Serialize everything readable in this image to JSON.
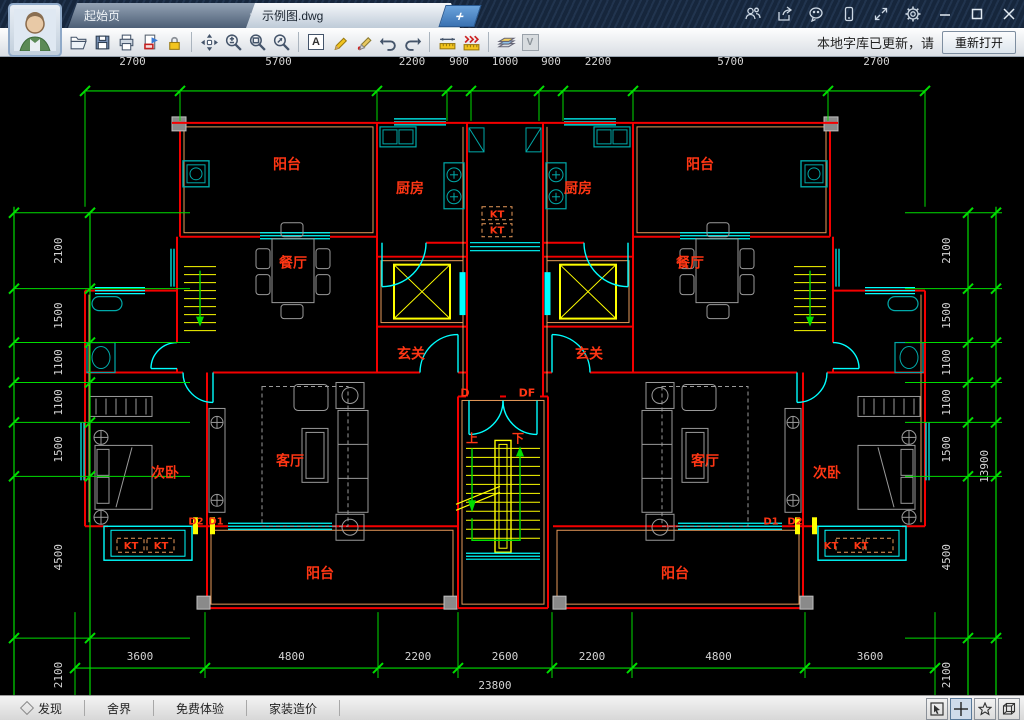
{
  "titlebar": {
    "tabs": [
      {
        "label": "起始页",
        "active": false
      },
      {
        "label": "示例图.dwg",
        "active": true
      }
    ],
    "plus_label": "+",
    "close_glyph": "×",
    "control_icons": [
      "contacts-icon",
      "share-icon",
      "wechat-icon",
      "mobile-icon",
      "fullscreen-icon",
      "settings-icon",
      "minimize-icon",
      "maximize-icon",
      "close-icon"
    ]
  },
  "toolbar": {
    "icons": [
      "open",
      "save",
      "print",
      "export-pdf",
      "lock",
      "pan",
      "zoom",
      "zoom-window",
      "zoom-extents",
      "text",
      "pencil",
      "marker",
      "undo",
      "redo",
      "measure",
      "measure-continuous",
      "layers",
      "view-v"
    ],
    "text_tool_letter": "A",
    "v_tool_letter": "V",
    "notice": "本地字库已更新，请",
    "reopen_button": "重新打开"
  },
  "statusbar": {
    "items": [
      "发现",
      "舍界",
      "免费体验",
      "家装造价"
    ],
    "right_buttons": [
      "select-mode-icon",
      "crosshair-mode-icon",
      "favorite-icon",
      "view-3d-icon"
    ]
  },
  "drawing": {
    "colors": {
      "wall": "#f40000",
      "wall_inner": "#e89a5a",
      "window": "#00ffff",
      "fixture": "#00a9a9",
      "dim_line": "#00dd00",
      "dim_text": "#d4d4d4",
      "label": "#ff3614",
      "stair": "#ffff00",
      "furniture": "#9a9a9a",
      "column": "#8a8a8a"
    },
    "labels": [
      {
        "t": "阳台",
        "x": 287,
        "y": 112
      },
      {
        "t": "阳台",
        "x": 700,
        "y": 112
      },
      {
        "t": "厨房",
        "x": 410,
        "y": 136
      },
      {
        "t": "厨房",
        "x": 578,
        "y": 136
      },
      {
        "t": "餐厅",
        "x": 293,
        "y": 211
      },
      {
        "t": "餐厅",
        "x": 690,
        "y": 211
      },
      {
        "t": "玄关",
        "x": 411,
        "y": 302
      },
      {
        "t": "玄关",
        "x": 589,
        "y": 302
      },
      {
        "t": "客厅",
        "x": 290,
        "y": 409
      },
      {
        "t": "客厅",
        "x": 705,
        "y": 409
      },
      {
        "t": "次卧",
        "x": 165,
        "y": 421
      },
      {
        "t": "次卧",
        "x": 827,
        "y": 421
      },
      {
        "t": "阳台",
        "x": 320,
        "y": 522
      },
      {
        "t": "阳台",
        "x": 675,
        "y": 522
      },
      {
        "t": "上",
        "x": 472,
        "y": 386,
        "s": 12
      },
      {
        "t": "下",
        "x": 518,
        "y": 386,
        "s": 12
      },
      {
        "t": "D",
        "x": 465,
        "y": 340,
        "s": 11
      },
      {
        "t": "DF",
        "x": 527,
        "y": 340,
        "s": 11
      },
      {
        "t": "D2",
        "x": 196,
        "y": 468,
        "s": 10
      },
      {
        "t": "D1",
        "x": 216,
        "y": 468,
        "s": 10
      },
      {
        "t": "D1",
        "x": 771,
        "y": 468,
        "s": 10
      },
      {
        "t": "D2",
        "x": 795,
        "y": 468,
        "s": 10
      },
      {
        "t": "KT",
        "x": 497,
        "y": 161,
        "s": 10
      },
      {
        "t": "KT",
        "x": 497,
        "y": 177,
        "s": 10
      },
      {
        "t": "KT",
        "x": 131,
        "y": 493,
        "s": 10
      },
      {
        "t": "KT",
        "x": 161,
        "y": 493,
        "s": 10
      },
      {
        "t": "KT",
        "x": 831,
        "y": 493,
        "s": 10
      },
      {
        "t": "KT",
        "x": 861,
        "y": 493,
        "s": 10
      }
    ],
    "dims": {
      "top": {
        "values": [
          "2700",
          "5700",
          "2200",
          "900",
          "1000",
          "900",
          "2200",
          "5700",
          "2700"
        ],
        "ticks": [
          85,
          180,
          377,
          447,
          471,
          539,
          563,
          633,
          828,
          925
        ],
        "line_y": 34,
        "label_y": 8
      },
      "bottom": {
        "values": [
          "3600",
          "4800",
          "2200",
          "2600",
          "2200",
          "4800",
          "3600"
        ],
        "ticks": [
          75,
          205,
          378,
          458,
          552,
          632,
          805,
          935
        ],
        "line_y": 612,
        "label_y": 604,
        "total": "23800",
        "total_x": 495,
        "total_y": 633
      },
      "left": {
        "values": [
          "2100",
          "1500",
          "1100",
          "1100",
          "1500",
          "4500",
          "2100"
        ],
        "ticks": [
          156,
          232,
          286,
          326,
          366,
          420,
          582,
          656
        ],
        "line_x": 90,
        "outer_line_x": 14,
        "label_x": 62
      },
      "right": {
        "values": [
          "2100",
          "1500",
          "1100",
          "1100",
          "1500",
          "4500",
          "2100"
        ],
        "ticks": [
          156,
          232,
          286,
          326,
          366,
          420,
          582,
          656
        ],
        "line_x": 968,
        "outer_line_x": 996,
        "label_x": 950,
        "total": "13900",
        "total_x": 988,
        "total_y": 410
      }
    }
  }
}
